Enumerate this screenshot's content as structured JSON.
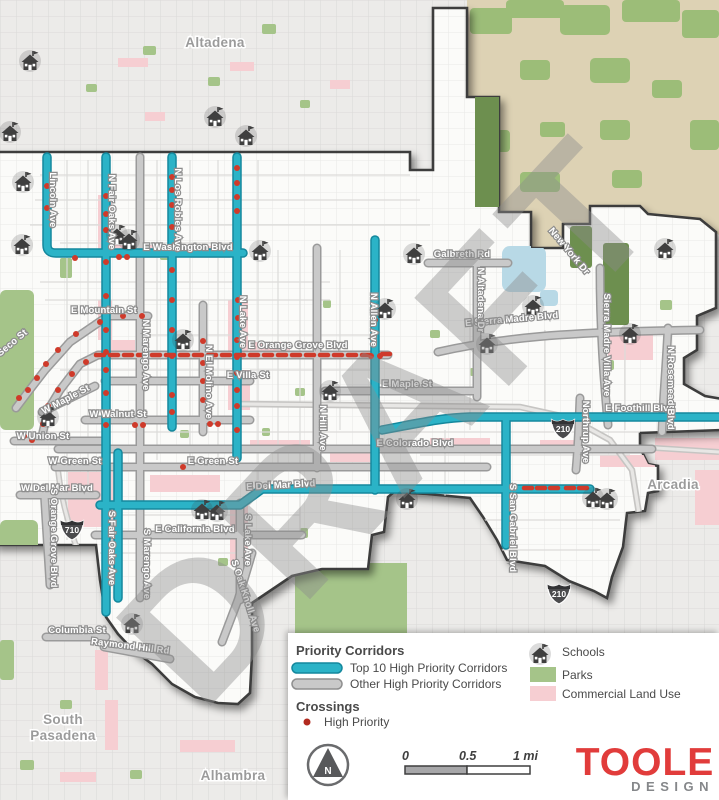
{
  "map": {
    "watermark": "DRAFT",
    "cities": {
      "altadena": "Altadena",
      "arcadia": "Arcadia",
      "south_pasadena_1": "South",
      "south_pasadena_2": "Pasadena",
      "alhambra": "Alhambra"
    },
    "shields": {
      "i710": "710",
      "i210": "210"
    },
    "streets": {
      "lincoln": "Lincoln Ave",
      "fair_oaks_n": "N Fair Oaks Ave",
      "los_robles": "N Los Robles Ave",
      "lake_n": "N Lake Ave",
      "marengo_n": "N Marengo Ave",
      "el_molino": "N El Molino Ave",
      "hill": "N Hill Ave",
      "allen": "N Allen Ave",
      "washington": "E Washington Blvd",
      "mountain": "E Mountain St",
      "orange_grove_e": "E Orange Grove Blvd",
      "villa": "E Villa St",
      "walnut": "W Walnut St",
      "maple_w": "W Maple St",
      "maple_e": "E Maple St",
      "union": "W Union St",
      "green_w": "W Green St",
      "green_e": "E Green St",
      "colorado": "E Colorado Blvd",
      "del_mar_w": "W Del Mar Blvd",
      "del_mar_e": "E Del Mar Blvd",
      "california": "E California Blvd",
      "fair_oaks_s": "S Fair Oaks Ave",
      "marengo_s": "S Marengo Ave",
      "lake_s": "S Lake Ave",
      "orange_grove_s": "S Orange Grove Blvd",
      "oak_knoll": "S Oak Knoll Ave",
      "columbia": "Columbia St",
      "raymond_hill": "Raymond Hill Rd",
      "galbreth": "Galbreth Rd",
      "altadena_dr": "N Altadena Dr",
      "new_york": "New York Dr",
      "sierra_madre": "E Sierra Madre Blvd",
      "sierra_madre_villa": "Sierra Madre Villa Ave",
      "rosemead": "N Rosemead Blvd",
      "northrup": "Northrup Ave",
      "foothill": "E Foothill Blvd",
      "san_gabriel": "S San Gabriel Blvd",
      "seco": "Seco St"
    }
  },
  "legend": {
    "corridors_title": "Priority Corridors",
    "top10": "Top 10 High Priority Corridors",
    "other": "Other High Priority Corridors",
    "crossings_title": "Crossings",
    "high_priority": "High Priority",
    "schools": "Schools",
    "parks": "Parks",
    "commercial": "Commercial Land Use"
  },
  "scalebar": {
    "zero": "0",
    "half": "0.5",
    "one": "1 mi"
  },
  "north_label": "N",
  "logo": {
    "name": "TOOLE",
    "sub": "DESIGN"
  },
  "colors": {
    "top10": "#2bb3c7",
    "top10_casing": "#14889d",
    "other": "#c9c9c9",
    "other_casing": "#9a9a9a",
    "crossing": "#cf3a2a",
    "legend_dot": "#b22a1f",
    "park": "#a5c489",
    "commercial": "#f6ced2",
    "logo_red": "#e13c3b",
    "logo_gray": "#85878a"
  },
  "schools": [
    [
      30,
      62
    ],
    [
      10,
      133
    ],
    [
      23,
      183
    ],
    [
      215,
      118
    ],
    [
      246,
      137
    ],
    [
      117,
      236
    ],
    [
      129,
      241
    ],
    [
      22,
      246
    ],
    [
      260,
      252
    ],
    [
      183,
      341
    ],
    [
      330,
      392
    ],
    [
      48,
      418
    ],
    [
      414,
      255
    ],
    [
      385,
      310
    ],
    [
      487,
      345
    ],
    [
      533,
      307
    ],
    [
      665,
      250
    ],
    [
      630,
      335
    ],
    [
      202,
      511
    ],
    [
      217,
      512
    ],
    [
      407,
      500
    ],
    [
      132,
      625
    ],
    [
      593,
      499
    ],
    [
      607,
      500
    ]
  ],
  "crossings": {
    "dots": [
      [
        106,
        196
      ],
      [
        106,
        214
      ],
      [
        106,
        230
      ],
      [
        106,
        262
      ],
      [
        106,
        296
      ],
      [
        106,
        330
      ],
      [
        106,
        352
      ],
      [
        106,
        370
      ],
      [
        106,
        393
      ],
      [
        106,
        425
      ],
      [
        47,
        186
      ],
      [
        47,
        208
      ],
      [
        75,
        258
      ],
      [
        119,
        257
      ],
      [
        127,
        257
      ],
      [
        172,
        177
      ],
      [
        172,
        190
      ],
      [
        172,
        205
      ],
      [
        172,
        227
      ],
      [
        172,
        247
      ],
      [
        172,
        270
      ],
      [
        172,
        300
      ],
      [
        172,
        330
      ],
      [
        172,
        356
      ],
      [
        172,
        395
      ],
      [
        172,
        412
      ],
      [
        237,
        168
      ],
      [
        237,
        183
      ],
      [
        237,
        197
      ],
      [
        237,
        211
      ],
      [
        238,
        300
      ],
      [
        238,
        318
      ],
      [
        237,
        340
      ],
      [
        237,
        357
      ],
      [
        237,
        373
      ],
      [
        237,
        390
      ],
      [
        237,
        406
      ],
      [
        237,
        430
      ],
      [
        203,
        341
      ],
      [
        203,
        363
      ],
      [
        203,
        381
      ],
      [
        203,
        400
      ],
      [
        375,
        320
      ],
      [
        371,
        356
      ],
      [
        380,
        356
      ],
      [
        142,
        316
      ],
      [
        123,
        316
      ],
      [
        100,
        322
      ],
      [
        76,
        334
      ],
      [
        58,
        350
      ],
      [
        46,
        364
      ],
      [
        37,
        378
      ],
      [
        28,
        390
      ],
      [
        19,
        398
      ],
      [
        86,
        362
      ],
      [
        72,
        374
      ],
      [
        58,
        390
      ],
      [
        48,
        406
      ],
      [
        43,
        424
      ],
      [
        135,
        425
      ],
      [
        143,
        425
      ],
      [
        210,
        424
      ],
      [
        218,
        424
      ],
      [
        24,
        436
      ],
      [
        32,
        440
      ],
      [
        183,
        467
      ]
    ],
    "dashes": [
      [
        100,
        355
      ],
      [
        114,
        355
      ],
      [
        128,
        355
      ],
      [
        142,
        355
      ],
      [
        156,
        355
      ],
      [
        170,
        355
      ],
      [
        184,
        355
      ],
      [
        198,
        355
      ],
      [
        212,
        355
      ],
      [
        226,
        355
      ],
      [
        240,
        355
      ],
      [
        254,
        355
      ],
      [
        268,
        355
      ],
      [
        282,
        355
      ],
      [
        296,
        355
      ],
      [
        310,
        355
      ],
      [
        324,
        355
      ],
      [
        338,
        355
      ],
      [
        352,
        355
      ],
      [
        366,
        355
      ],
      [
        386,
        354
      ],
      [
        528,
        488
      ],
      [
        541,
        488
      ],
      [
        554,
        488
      ],
      [
        570,
        488
      ],
      [
        583,
        488
      ]
    ]
  }
}
